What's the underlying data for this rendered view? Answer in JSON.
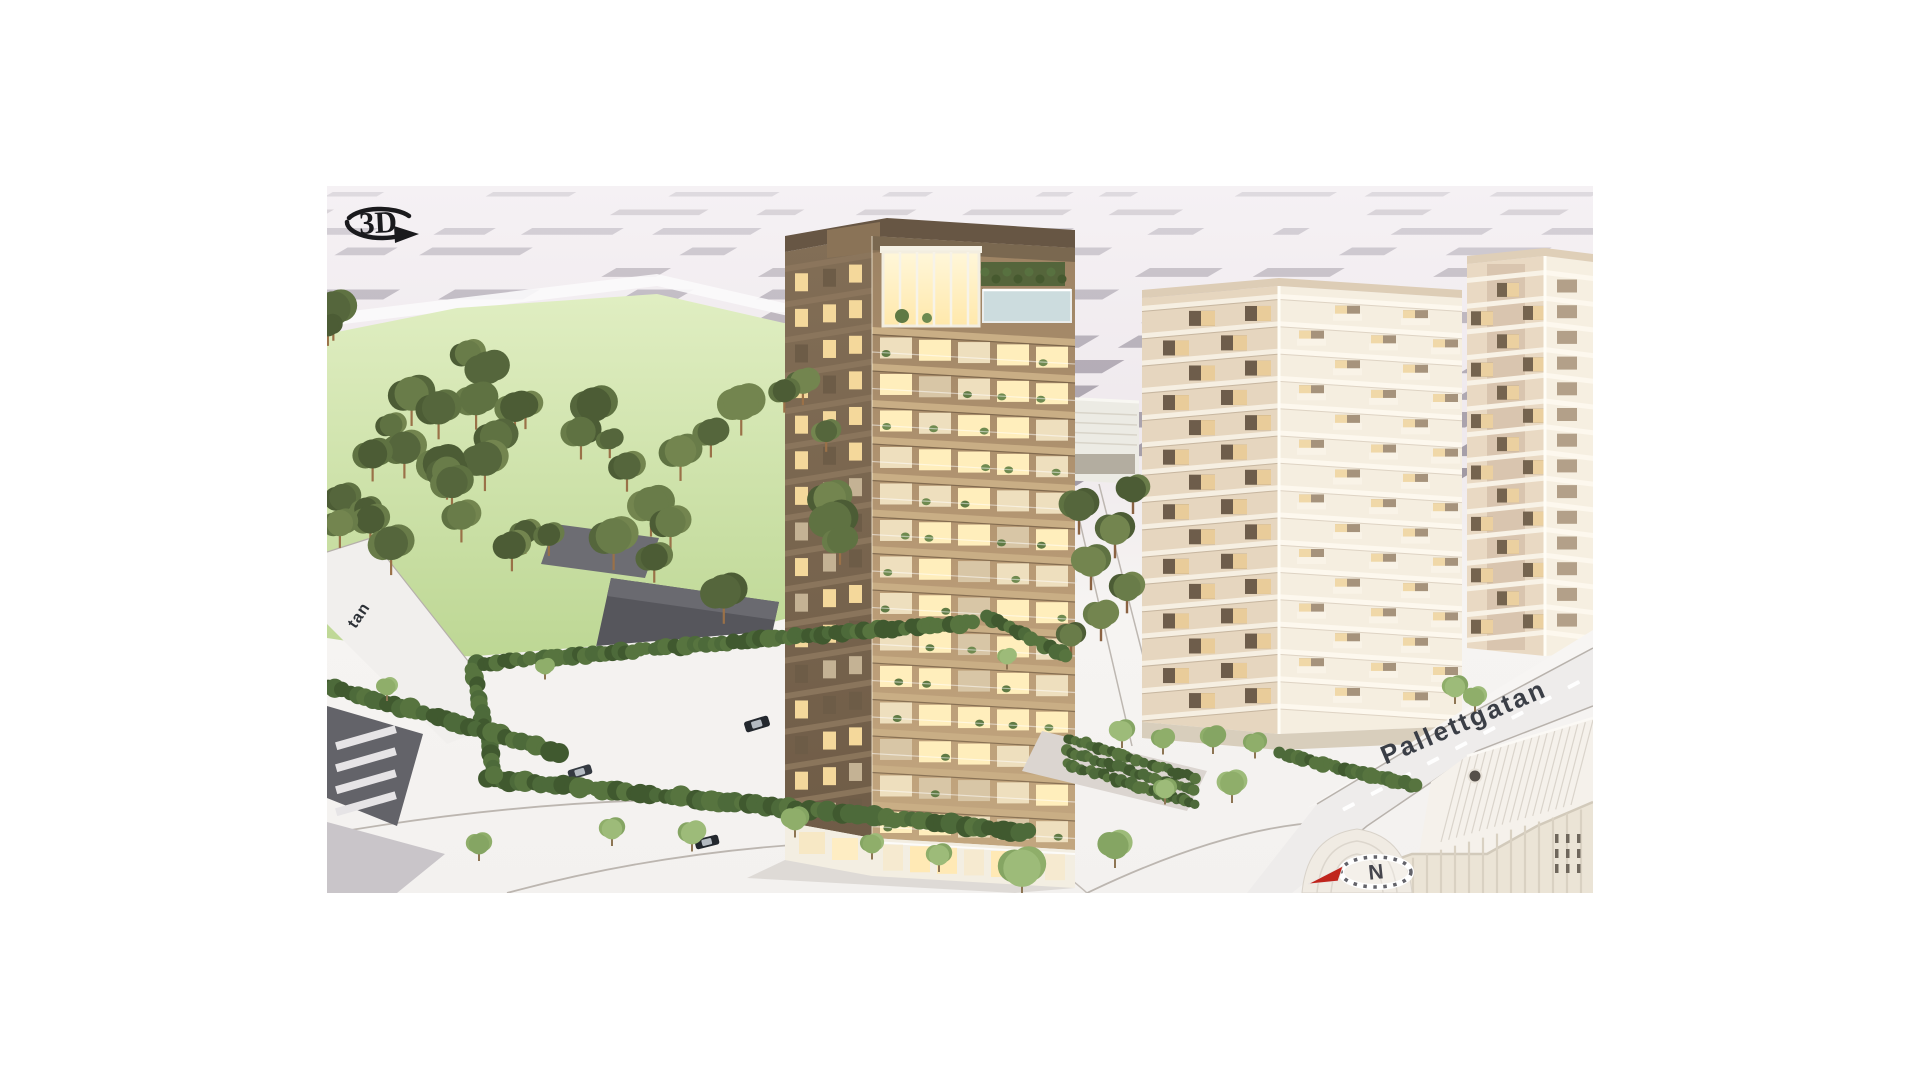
{
  "viewer": {
    "icon_3d_label": "3D",
    "compass_north_label": "N"
  },
  "streets": {
    "main_label": "Pallettgatan",
    "left_fragment": "tan"
  },
  "colors": {
    "canvas_background": "#ffffff",
    "map_ground": "#f1ecef",
    "building_footprint": "#8f8894",
    "park_lawn": "#cfe2ab",
    "pine_canopy": "#5d6e3f",
    "light_tree_canopy": "#95b170",
    "main_tower_facade": "#ab906d",
    "main_tower_floor_band": "#c9ae85",
    "window_glow": "#ffeebc",
    "white_tower_lit_face": "#f5eee0",
    "white_tower_shaded_face": "#e6d6bf",
    "balcony_recess": "#6e5d4b",
    "warehouse_white": "#f3efe8",
    "road_surface": "#eeeceb",
    "street_label_text": "#3a3e46",
    "compass_arrow_red": "#c0251d",
    "icon_ink": "#1a1a1d"
  }
}
